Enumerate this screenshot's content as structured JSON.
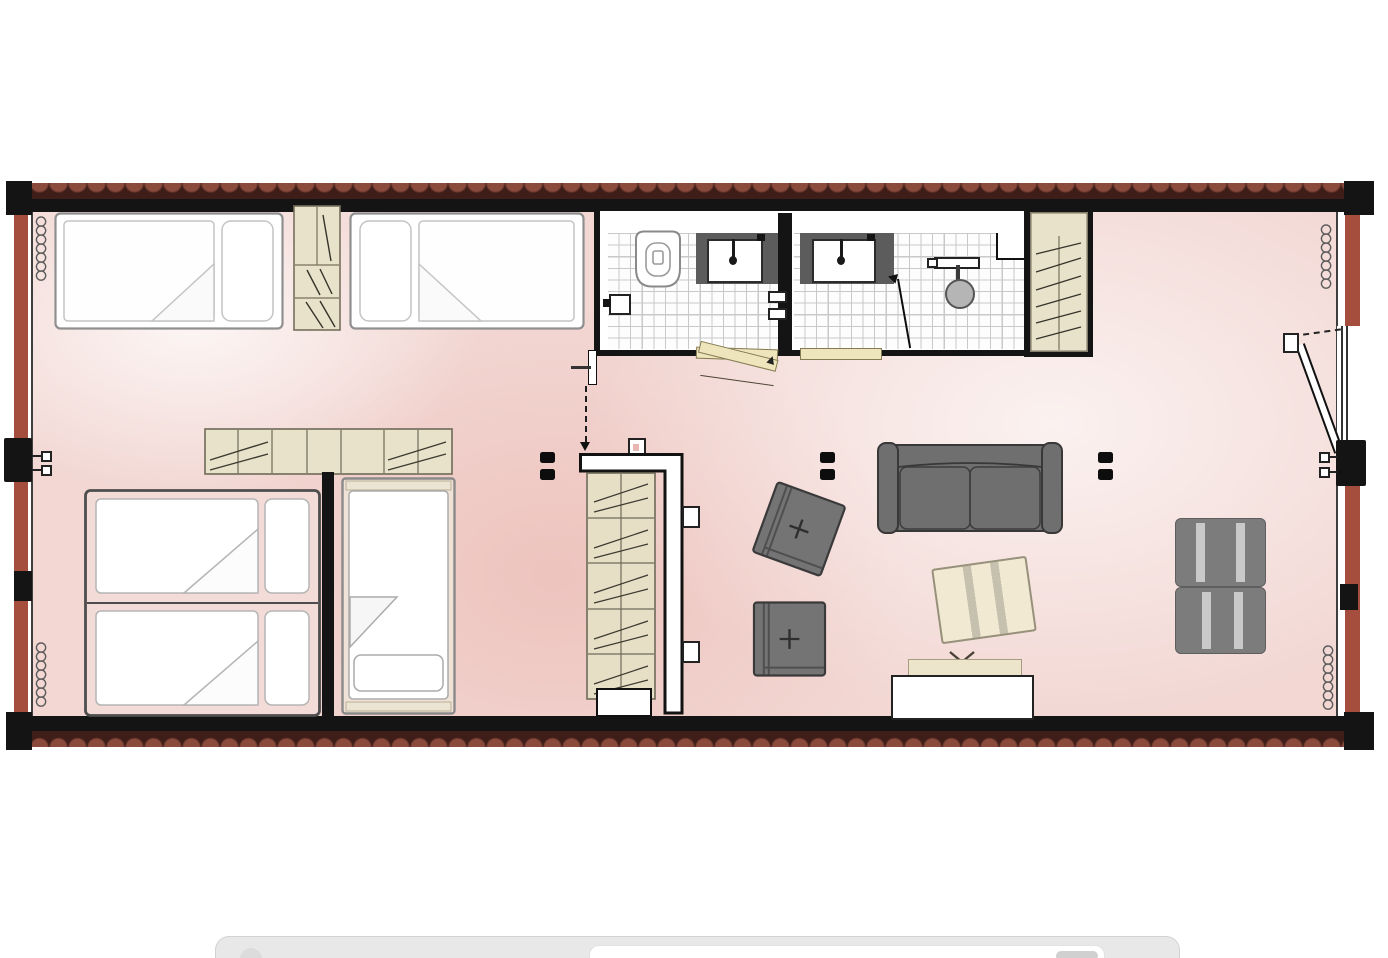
{
  "app": {
    "type": "image viewer page",
    "content": "apartment floor plan drawing"
  },
  "plan": {
    "label": "Container apartment floor plan",
    "palette": {
      "shell_red": "#a64e3e",
      "corrugation_dark": "#3f1d19",
      "corrugation_light": "#8a4a3c",
      "wall_black": "#141414",
      "floor_pink": "#f2d7d3",
      "cabinet_beige": "#e9e2ca",
      "door_beige": "#efe5bd",
      "sofa_gray": "#6f6f6f",
      "mat_gray": "#7c7c7c",
      "table_cream": "#f1e9d2",
      "fixture_dark_gray": "#5c5c5c"
    },
    "rooms": {
      "bedroom_upper": {
        "label": "Upper twin bedroom",
        "furniture": [
          "single bed",
          "shelf cabinet",
          "single bed"
        ]
      },
      "bathroom_left": {
        "label": "Bathroom with WC",
        "furniture": [
          "toilet",
          "washbasin",
          "toilet roll holder",
          "swing door"
        ]
      },
      "bathroom_right": {
        "label": "Shower room",
        "furniture": [
          "washbasin",
          "shower head",
          "swing door"
        ]
      },
      "closet": {
        "label": "Built-in closet",
        "furniture": [
          "shelf unit"
        ]
      },
      "bedroom_lower": {
        "label": "Lower bedroom",
        "furniture": [
          "wall shelf",
          "double bed",
          "single bed"
        ]
      },
      "living_room": {
        "label": "Living area",
        "furniture": [
          "wardrobe shelf",
          "sofa",
          "armchair",
          "armchair",
          "coffee table",
          "TV stand",
          "floor mats"
        ]
      }
    },
    "symbols": [
      "radiator coil",
      "wall socket pair",
      "door swing line",
      "entry arrow"
    ]
  },
  "bottom_bar": {
    "label": "browser tab bar",
    "address_field": {
      "value": ""
    },
    "tab_button": {
      "label": ""
    }
  }
}
